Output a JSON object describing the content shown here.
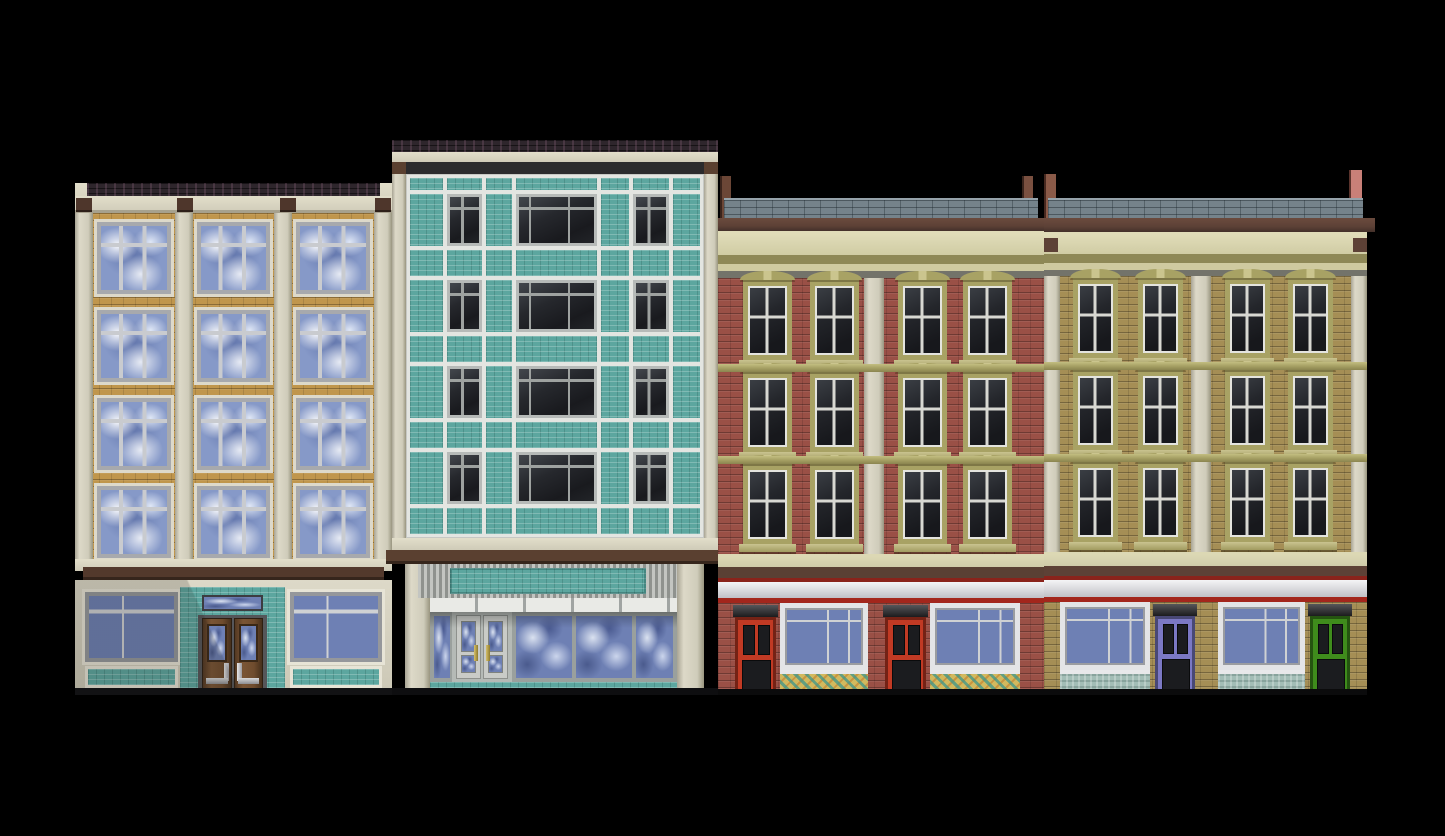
{
  "scene": {
    "type": "pixel-art building facade row",
    "background_color": "#000000",
    "ground_line_y": 695,
    "buildings": [
      {
        "id": "tan-brick-walkup",
        "style": "brick apartment over storefront",
        "floors": 4,
        "windows_per_floor": 3,
        "colors": {
          "brick": "#c0964c",
          "pilaster": "#d8d4c3",
          "roofbrick": "#271e24",
          "accent": "#4e362b",
          "band": "#53392c",
          "wall": "#d6d2c1",
          "tile": "#5ca69f",
          "door": "#6f4c2e",
          "glass": "#8699c8"
        },
        "storefront": {
          "display_windows": 2,
          "door": "wood double door with glass and transom"
        }
      },
      {
        "id": "teal-panel-midcentury",
        "style": "curtain wall with teal tile spandrels",
        "floors": 4,
        "windows_per_floor": 3,
        "colors": {
          "tile": "#5ca69f",
          "mullion": "#e3e5e1",
          "pilaster": "#d2cfbd",
          "window": "#222428",
          "band": "#5a4030",
          "awning_light": "#c3c5c1",
          "awning_dark": "#8f928e",
          "glass": "#6e80b4",
          "doorframe": "#c9cbc7",
          "handle": "#b09a44"
        },
        "storefront": {
          "display_windows": 4,
          "door": "glass double door",
          "awning": true
        }
      },
      {
        "id": "red-brick-victorian",
        "style": "Victorian brick with arched window hoods",
        "floors": 3,
        "windows_per_floor": 4,
        "colors": {
          "brick": "#9a5046",
          "trim": "#a8a264",
          "cornice": "#d0cca4",
          "cap": "#75838b",
          "beam": "#5d4136",
          "post_left": "#6b4636",
          "post_right": "#7a5040",
          "fascia": "#eceef0",
          "stripe_top": "#8a231b",
          "stripe_bottom": "#a3261c",
          "door": "#c13a24",
          "bulkhead": "#d2b95e",
          "glass": "#6e80b4"
        },
        "storefront": {
          "shops": 2,
          "doors": 2,
          "display_windows": 2
        }
      },
      {
        "id": "olive-brick-victorian",
        "style": "Victorian brick with arched window hoods",
        "floors": 3,
        "windows_per_floor": 4,
        "colors": {
          "brick": "#a58e55",
          "trim": "#a8a264",
          "cornice": "#d0cca4",
          "cap": "#75838b",
          "beam": "#5d4136",
          "post_left": "#8a5a48",
          "post_right": "#c98078",
          "fascia": "#eceef0",
          "stripe_top": "#8a231b",
          "stripe_bottom": "#a3261c",
          "door_left": "#7b78c4",
          "door_right": "#3f8c1c",
          "bulkhead": "#a3bdb6",
          "glass": "#6e80b4"
        },
        "storefront": {
          "shops": 2,
          "doors": 2,
          "display_windows": 2
        }
      }
    ]
  }
}
